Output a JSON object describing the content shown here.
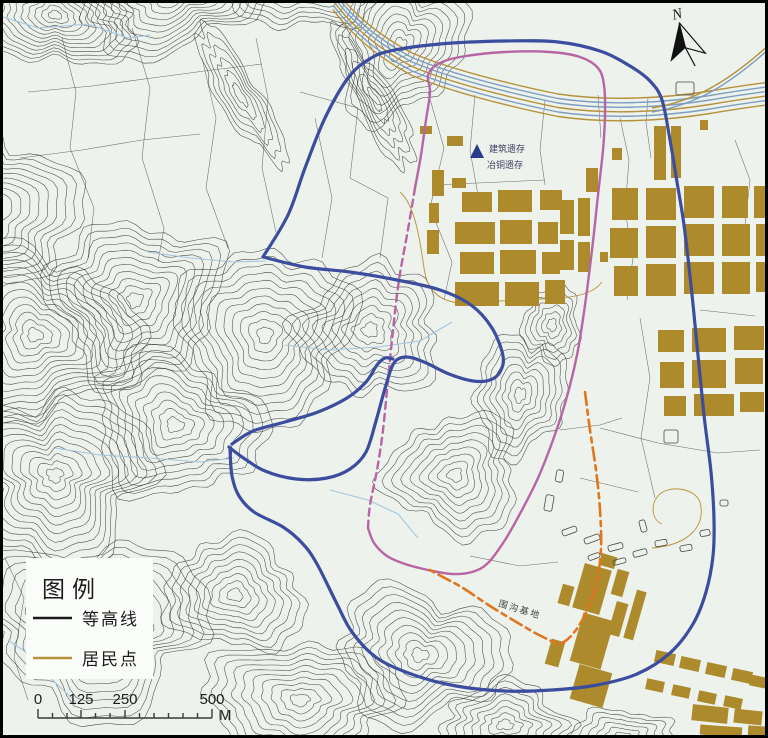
{
  "map": {
    "north_label": "N",
    "site_labels": {
      "building": "建筑遗存",
      "smelting": "冶铜遗存",
      "ditch": "围沟基地"
    }
  },
  "legend": {
    "title": "图例",
    "items": [
      {
        "label": "等高线",
        "swatch_color": "#1a1a1a"
      },
      {
        "label": "居民点",
        "swatch_color": "#b5913a"
      }
    ]
  },
  "scalebar": {
    "labels": [
      "0",
      "125",
      "250",
      "500"
    ],
    "unit": "M"
  },
  "colors": {
    "background": "#edf2ec",
    "contour": "#3b3b3b",
    "residential": "#ad8a2b",
    "boundary_blue": "#3c4c9e",
    "boundary_magenta": "#b765a4",
    "boundary_orange": "#e0761f",
    "stream": "#a3c6de"
  }
}
